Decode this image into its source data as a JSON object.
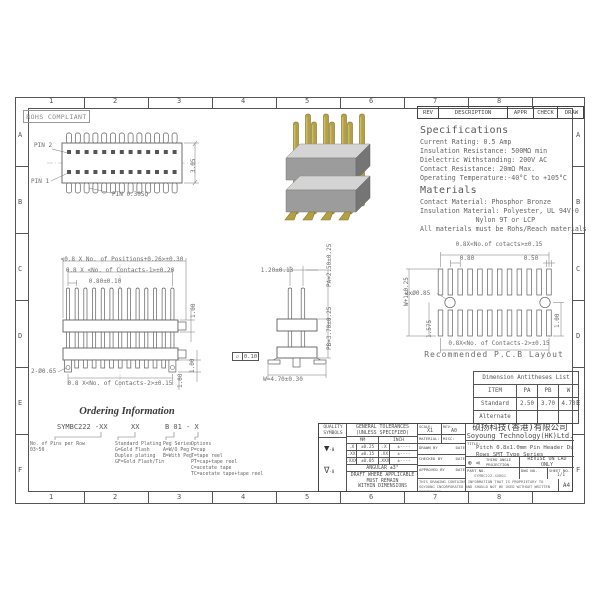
{
  "sheet": {
    "rohs": "ROHS COMPLIANT",
    "zone_cols": [
      "1",
      "2",
      "3",
      "4",
      "5",
      "6",
      "7",
      "8"
    ],
    "zone_rows": [
      "A",
      "B",
      "C",
      "D",
      "E",
      "F"
    ]
  },
  "rev_table": {
    "headers": [
      "REV",
      "DESCRIPTION",
      "APPR",
      "CHECK",
      "DRAW"
    ]
  },
  "specs": {
    "title": "Specifications",
    "lines": [
      "Current Rating: 0.5 Amp",
      "Insulation Resistance: 500MΩ min",
      "Dielectric Withstanding: 200V AC",
      "Contact Resistance: 20mΩ Max.",
      "Operating Temperature:-40°C to +105°C"
    ]
  },
  "materials": {
    "title": "Materials",
    "lines": [
      "Contact Material: Phosphor Bronze",
      "Insulation Material: Polyester, UL 94V-0",
      "              Nylon 9T or LCP",
      "All materials must be Rohs/Reach materials"
    ]
  },
  "top_view": {
    "pin2": "PIN 2",
    "pin1": "PIN 1",
    "pin_sq": "PIN 0.30SQ",
    "height": "3.05"
  },
  "front_view": {
    "dim_positions": "<0.8 X No. of Positions+0.26>±0.30",
    "dim_contacts1": "0.8 X <No. of Contacts-1>±0.20",
    "dim_pitch": "0.80±0.10",
    "dim_h1": "1.00",
    "dim_h2": "1.00",
    "dim_h3": "1.00",
    "dim_hole": "2-Ø0.65",
    "dim_contacts2": "0.8 X<No. of Contacts-2>±0.15"
  },
  "side_view": {
    "dim_top": "1.20±0.13",
    "dim_pa": "PA=2.50±0.25",
    "dim_pb": "PB=3.70±0.25",
    "flat_sym": "▱",
    "flat_val": "0.10",
    "dim_w": "W=4.70±0.30"
  },
  "pcb": {
    "dim_top": "0.8X<No.of cotacts>±0.15",
    "dim_080": "0.80",
    "dim_050": "0.50",
    "dim_holes": "2xØ0.85",
    "dim_w1": "W+1±0.25",
    "dim_1575": "1.575",
    "dim_100": "1.00",
    "dim_bottom": "0.8X<No. of Contacts-2>±0.15",
    "caption": "Recommended P.C.B Layout"
  },
  "dim_table": {
    "title": "Dimension Antitheses List",
    "headers": [
      "ITEM",
      "PA",
      "PB",
      "W"
    ],
    "rows": [
      [
        "Standard",
        "2.50",
        "3.70",
        "4.70"
      ],
      [
        "Alternate",
        "",
        "",
        ""
      ]
    ]
  },
  "ordering": {
    "title": "Ordering Information",
    "code1": "SYMBC222 -XX",
    "code2": "XX",
    "code3": "B 01 - X",
    "col1": [
      "No. of Pins per Row",
      "03~50"
    ],
    "col2": [
      "Standard Plating",
      "G=Gold Flash",
      "Duplex plating",
      "GF=Gold Flash/Tin"
    ],
    "col3": [
      "Peg Series",
      "A=W/O Peg",
      "B=With Peg"
    ],
    "col4": [
      "Options",
      "P=cap",
      "T=tape reel",
      "PT=cap+tape reel",
      "C=acetate tape",
      "TC=acetate tape+tape reel"
    ]
  },
  "title_block": {
    "quality_header": "QUALITY SYMBOLS",
    "sym1": "▼",
    "sym1_sub": "-0",
    "sym2": "∇",
    "sym2_sub": "-0",
    "tol_header": "GENERAL TOLERANCES\n(UNLESS SPECIFIED)",
    "col_mm": "MM",
    "col_inch": "INCH",
    "tol_rows": [
      [
        ".X",
        "±0.25",
        ".X",
        "±----"
      ],
      [
        ".XX",
        "±0.15",
        ".XX",
        "±----"
      ],
      [
        ".XXX",
        "±0.05",
        ".XXX",
        "±----"
      ]
    ],
    "angular": "ANGULAR ±3°",
    "draft": "DRAFT WHERE APPLICABLE\nMUST REMAIN\nWITHIN DIMENSIONS",
    "scale_label": "SCALE:",
    "scale_value": "X1",
    "rev_label": "REV:",
    "rev_value": "A0",
    "material_label": "MATERIAL:",
    "misc_label": "MISC:",
    "drawn": "DRAWN BY",
    "checked": "CHECKED BY",
    "approved": "APPROVED BY",
    "date": "DATE",
    "company_cn": "硕扬科技(香港)有限公司",
    "company_en": "Soyoung Technology(HK)Ltd.",
    "title_label": "TITLE:",
    "title_value": "Pitch 0.8x1.0mm Pin Header Dual\nRows SMT Type Series",
    "projection_icons": "⊕ ⊲",
    "projection": "THIRD ANGLE\nPROJECTION",
    "revise": "REVISE ON CAD ONLY",
    "part_label": "PART NO.",
    "part_value": "SYMBC222-XXB01",
    "dwg_label": "DWG NO.",
    "sheet_label": "SHEET NO.",
    "sheet_value": "1/1",
    "disclaimer": "THIS DRAWING CONTAINS INFORMATION THAT IS PROPRIETARY TO SOYOUNG INCORPORATED AND SHOULD NOT BE USED WITHOUT WRITTEN PERMISSION",
    "paper": "A4"
  }
}
